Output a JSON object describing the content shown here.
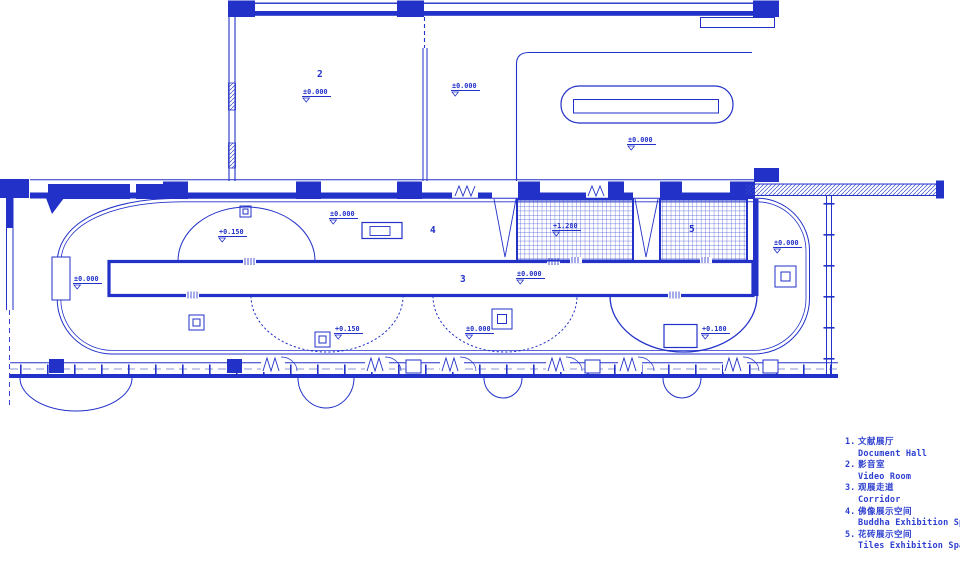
{
  "drawing": {
    "title_hint": "exhibition hall floor plan",
    "line_color": "#2231c8",
    "hatch_color": "#4456d2",
    "room_labels": [
      {
        "number": "2"
      },
      {
        "number": "3"
      },
      {
        "number": "4"
      },
      {
        "number": "5"
      }
    ],
    "markers": [
      {
        "value": "±0.000"
      },
      {
        "value": "±0.000"
      },
      {
        "value": "±0.000"
      },
      {
        "value": "±0.000"
      },
      {
        "value": "+0.150"
      },
      {
        "value": "±0.000"
      },
      {
        "value": "±0.000"
      },
      {
        "value": "+1.280"
      },
      {
        "value": "+0.150"
      },
      {
        "value": "±0.000"
      },
      {
        "value": "+0.180"
      },
      {
        "value": "±0.000"
      }
    ]
  },
  "legend": {
    "items": [
      {
        "num": "1.",
        "zh": "文献展厅",
        "en": "Document Hall"
      },
      {
        "num": "2.",
        "zh": "影音室",
        "en": "Video Room"
      },
      {
        "num": "3.",
        "zh": "观展走道",
        "en": "Corridor"
      },
      {
        "num": "4.",
        "zh": "佛像展示空间",
        "en": "Buddha Exhibition Space"
      },
      {
        "num": "5.",
        "zh": "花砖展示空间",
        "en": "Tiles Exhibition Space"
      }
    ]
  }
}
